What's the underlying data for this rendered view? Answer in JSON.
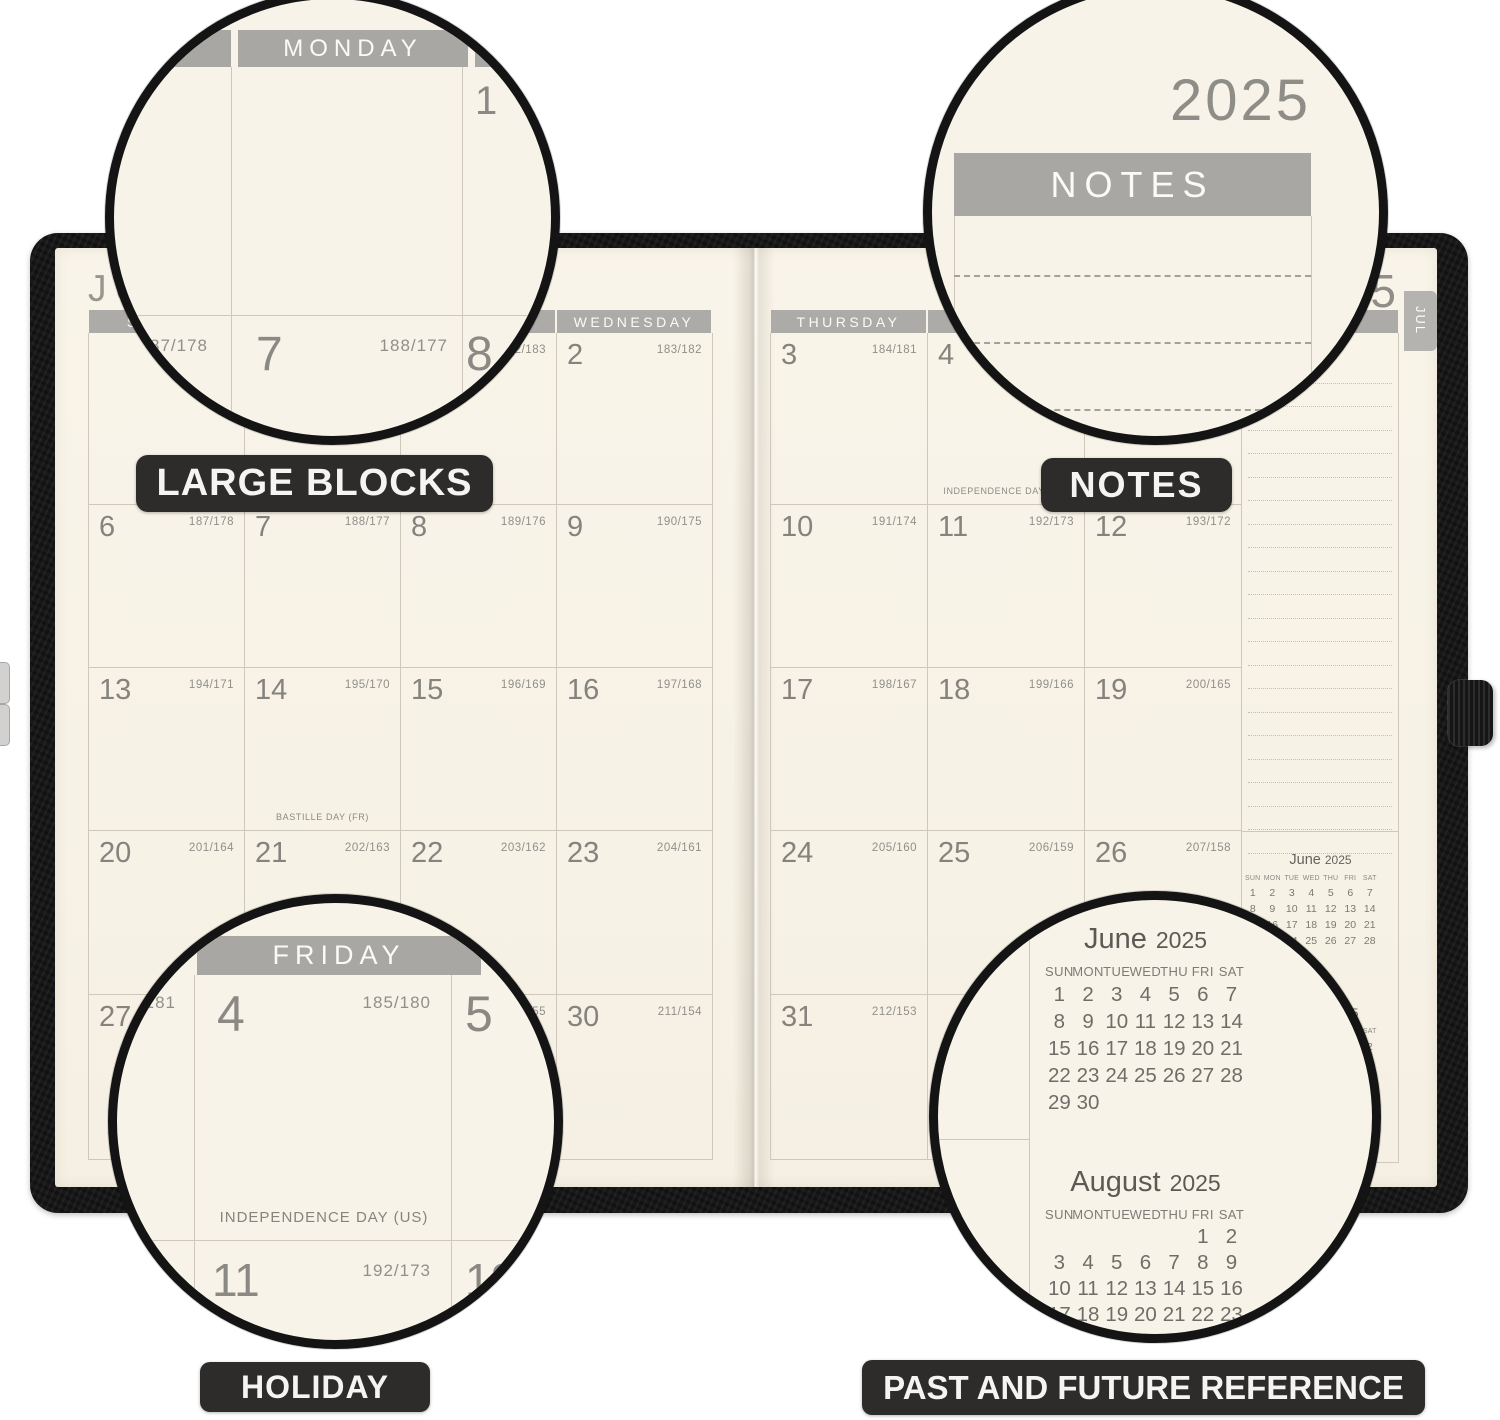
{
  "callouts": {
    "large_blocks": "LARGE BLOCKS",
    "notes": "NOTES",
    "holiday": "HOLIDAY",
    "reference": "PAST AND FUTURE REFERENCE"
  },
  "spread": {
    "month_title": "JULY",
    "year": "2025",
    "tab": "JUL",
    "notes_header": "NOTES",
    "day_headers": [
      "SUNDAY",
      "MONDAY",
      "TUESDAY",
      "WEDNESDAY",
      "THURSDAY",
      "FRIDAY",
      "SATURDAY"
    ],
    "weeks": [
      [
        {},
        {},
        {
          "d": "1",
          "n": "182/183"
        },
        {
          "d": "2",
          "n": "183/182"
        },
        {
          "d": "3",
          "n": "184/181"
        },
        {
          "d": "4",
          "n": "185/180",
          "h": "INDEPENDENCE DAY (US)"
        },
        {
          "d": "5",
          "n": "186/179"
        }
      ],
      [
        {
          "d": "6",
          "n": "187/178"
        },
        {
          "d": "7",
          "n": "188/177"
        },
        {
          "d": "8",
          "n": "189/176"
        },
        {
          "d": "9",
          "n": "190/175"
        },
        {
          "d": "10",
          "n": "191/174"
        },
        {
          "d": "11",
          "n": "192/173"
        },
        {
          "d": "12",
          "n": "193/172"
        }
      ],
      [
        {
          "d": "13",
          "n": "194/171"
        },
        {
          "d": "14",
          "n": "195/170",
          "h": "BASTILLE DAY (FR)"
        },
        {
          "d": "15",
          "n": "196/169"
        },
        {
          "d": "16",
          "n": "197/168"
        },
        {
          "d": "17",
          "n": "198/167"
        },
        {
          "d": "18",
          "n": "199/166"
        },
        {
          "d": "19",
          "n": "200/165"
        }
      ],
      [
        {
          "d": "20",
          "n": "201/164"
        },
        {
          "d": "21",
          "n": "202/163"
        },
        {
          "d": "22",
          "n": "203/162"
        },
        {
          "d": "23",
          "n": "204/161"
        },
        {
          "d": "24",
          "n": "205/160"
        },
        {
          "d": "25",
          "n": "206/159"
        },
        {
          "d": "26",
          "n": "207/158"
        }
      ],
      [
        {
          "d": "27",
          "n": "208/157"
        },
        {
          "d": "28",
          "n": "209/156"
        },
        {
          "d": "29",
          "n": "210/155"
        },
        {
          "d": "30",
          "n": "211/154"
        },
        {
          "d": "31",
          "n": "212/153"
        },
        {},
        {}
      ]
    ]
  },
  "minis": {
    "june": {
      "month": "June",
      "year": "2025",
      "dow": [
        "SUN",
        "MON",
        "TUE",
        "WED",
        "THU",
        "FRI",
        "SAT"
      ],
      "weeks": [
        [
          "1",
          "2",
          "3",
          "4",
          "5",
          "6",
          "7"
        ],
        [
          "8",
          "9",
          "10",
          "11",
          "12",
          "13",
          "14"
        ],
        [
          "15",
          "16",
          "17",
          "18",
          "19",
          "20",
          "21"
        ],
        [
          "22",
          "23",
          "24",
          "25",
          "26",
          "27",
          "28"
        ],
        [
          "29",
          "30",
          "",
          "",
          "",
          "",
          ""
        ]
      ]
    },
    "august": {
      "month": "August",
      "year": "2025",
      "dow": [
        "SUN",
        "MON",
        "TUE",
        "WED",
        "THU",
        "FRI",
        "SAT"
      ],
      "weeks": [
        [
          "",
          "",
          "",
          "",
          "",
          "1",
          "2"
        ],
        [
          "3",
          "4",
          "5",
          "6",
          "7",
          "8",
          "9"
        ],
        [
          "10",
          "11",
          "12",
          "13",
          "14",
          "15",
          "16"
        ],
        [
          "17",
          "18",
          "19",
          "20",
          "21",
          "22",
          "23"
        ],
        [
          "24",
          "25",
          "26",
          "27",
          "28",
          "29",
          "30"
        ],
        [
          "31",
          "",
          "",
          "",
          "",
          "",
          ""
        ]
      ]
    }
  },
  "colors": {
    "page_cream": "#f8f3e8",
    "header_bar_gray": "#adaba7",
    "grid_line": "#cdc8bb",
    "cover_black": "#181818",
    "chip_black": "#2d2c2a",
    "text_gray": "#84837e"
  }
}
